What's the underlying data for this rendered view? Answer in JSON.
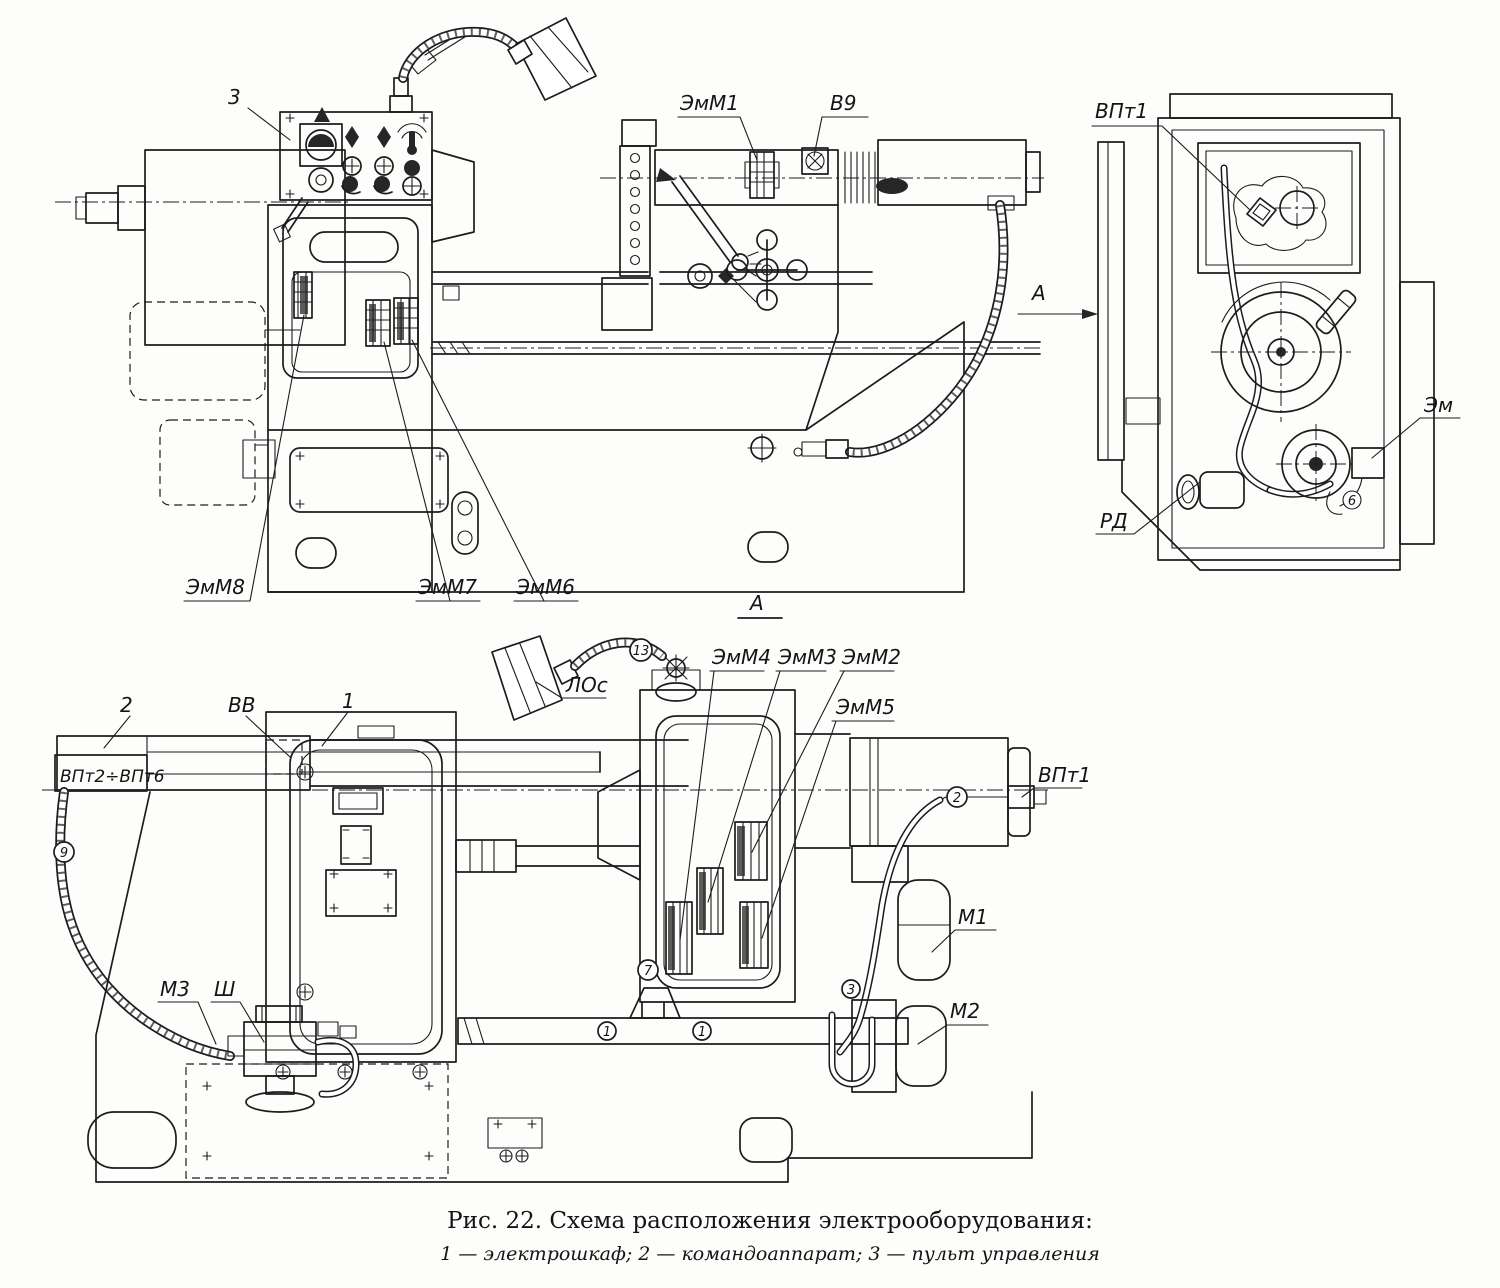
{
  "front_view": {
    "ref3": "3",
    "emm1": "ЭмМ1",
    "v9": "В9",
    "emm8": "ЭмМ8",
    "emm7": "ЭмМ7",
    "emm6": "ЭмМ6"
  },
  "end_view": {
    "view_label": "А",
    "vpt1": "ВПт1",
    "em": "Эм",
    "rd": "РД",
    "wire6": "6"
  },
  "plan_view": {
    "section_label": "А",
    "lamp": "ЛОс",
    "ref1": "1",
    "ref2": "2",
    "vv": "ВВ",
    "vpt_range": "ВПт2÷ВПт6",
    "emm4": "ЭмМ4",
    "emm3": "ЭмМ3",
    "emm2": "ЭмМ2",
    "emm5": "ЭмМ5",
    "vpt1": "ВПт1",
    "m1": "М1",
    "m2": "М2",
    "m3": "М3",
    "sh": "Ш",
    "wire13": "13",
    "wire9": "9",
    "wire7": "7",
    "wire1a": "1",
    "wire1b": "1",
    "wire2": "2",
    "wire3": "3"
  },
  "caption": {
    "title": "Рис. 22. Схема расположения электрооборудования:",
    "legend": "1 — электрошкаф; 2 — командоаппарат; 3 — пульт управления"
  }
}
